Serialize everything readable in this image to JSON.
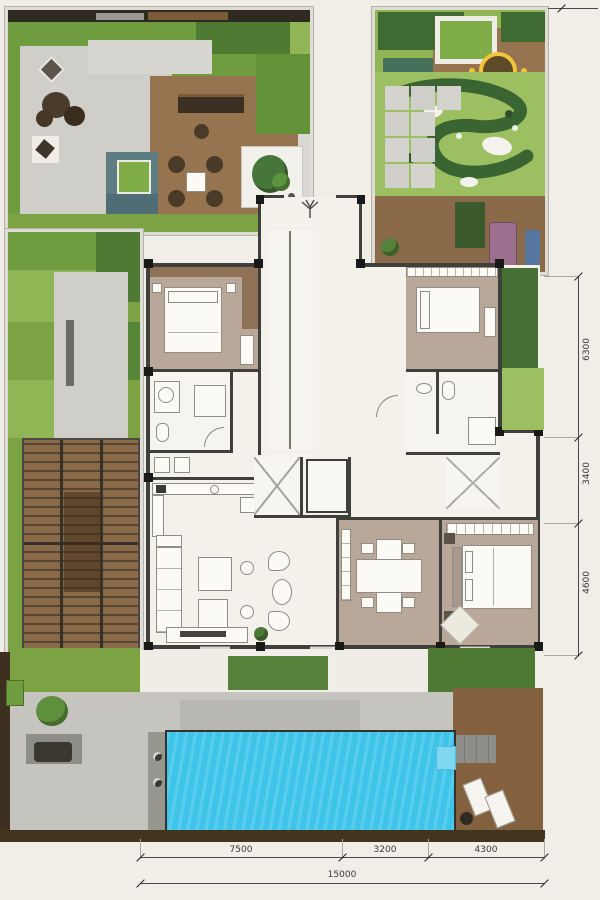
{
  "drawing": {
    "kind": "residential villa ground-floor site plan with gardens and pool"
  },
  "dimensions": {
    "bottom": {
      "segments": [
        {
          "label": "7500"
        },
        {
          "label": "3200"
        },
        {
          "label": "4300"
        }
      ],
      "total": {
        "label": "15000"
      }
    },
    "right": {
      "segments": [
        {
          "label": "6300"
        },
        {
          "label": "3400"
        },
        {
          "label": "4600"
        }
      ]
    }
  },
  "palette": {
    "paper": "#f1eee7",
    "grass_mid": "#6f9c3f",
    "grass_light": "#8fb554",
    "grass_pale": "#9cc061",
    "grass_dark": "#4e7a33",
    "hedge_dark": "#3f6b33",
    "deck_wood": "#96744f",
    "deck_wood_dark": "#83603e",
    "pergola_wood": "#8a6a48",
    "stone_paver": "#c6c4bf",
    "stone_light": "#d6d5d0",
    "pool_water": "#3fc4e9",
    "floor_taupe": "#b9a89a",
    "floor_white": "#f3f1ea",
    "wall_dark": "#3f3f3c",
    "teal_planter": "#5e7d83",
    "accent_yellow": "#f2c438",
    "lounge_purple": "#9c6f8f",
    "lounge_blue": "#5577a0",
    "soil_dark": "#41351f"
  }
}
